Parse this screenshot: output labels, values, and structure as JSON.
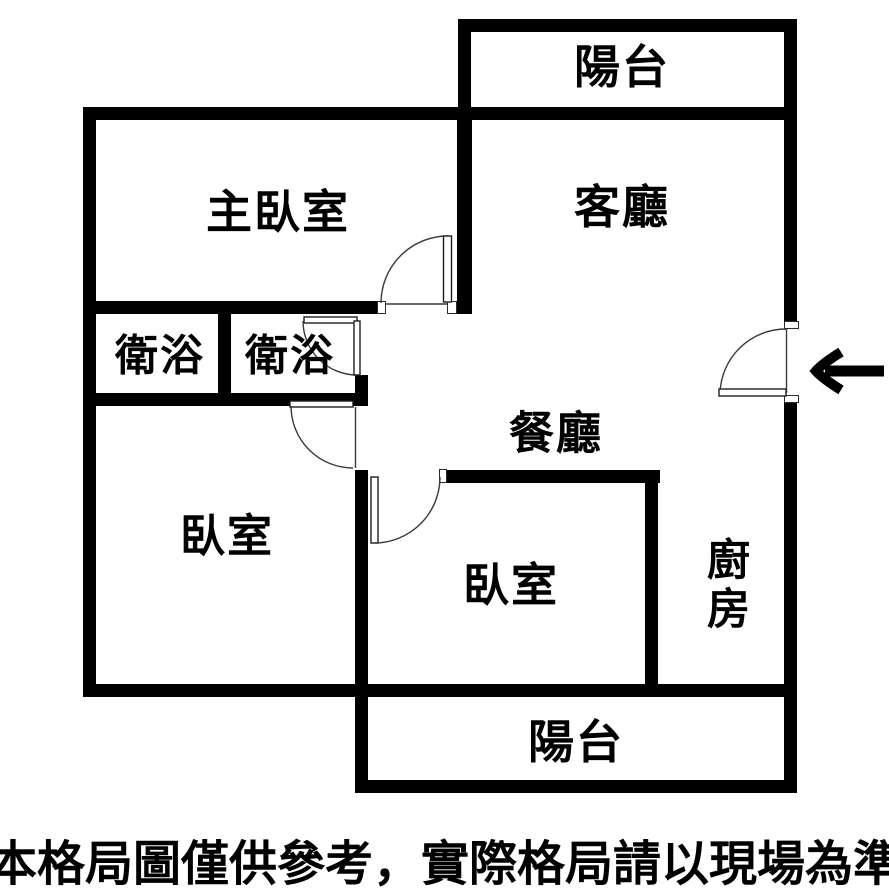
{
  "floorplan": {
    "rooms": {
      "balcony_top": {
        "label": "陽台"
      },
      "master_bedroom": {
        "label": "主臥室"
      },
      "living_room": {
        "label": "客廳"
      },
      "bathroom_1": {
        "label": "衛浴"
      },
      "bathroom_2": {
        "label": "衛浴"
      },
      "dining_room": {
        "label": "餐廳"
      },
      "bedroom_left": {
        "label": "臥室"
      },
      "bedroom_center": {
        "label": "臥室"
      },
      "kitchen": {
        "label": "廚房"
      },
      "balcony_bottom": {
        "label": "陽台"
      }
    },
    "icons": {
      "entrance_arrow": "left-arrow"
    },
    "colors": {
      "wall": "#000000",
      "background": "#ffffff",
      "text": "#000000"
    }
  },
  "disclaimer": "本格局圖僅供參考，實際格局請以現場為準"
}
